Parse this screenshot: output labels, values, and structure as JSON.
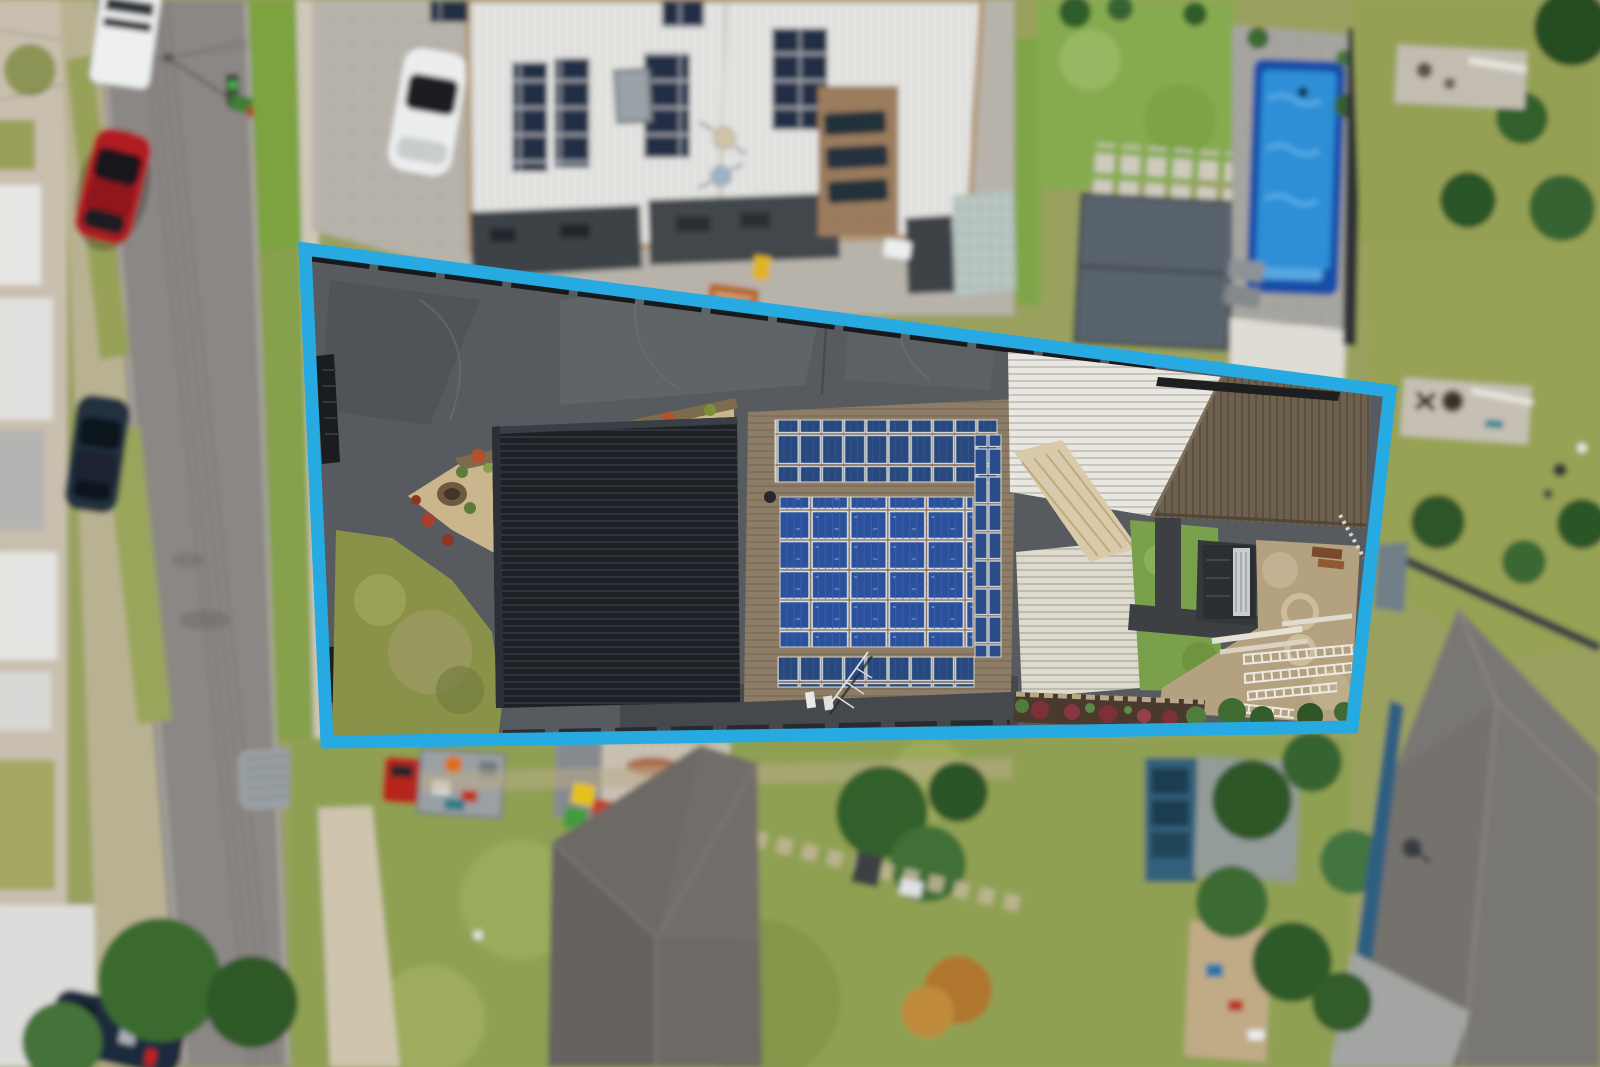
{
  "scene": {
    "type": "aerial-drone-photo",
    "description": "Top-down drone photograph of a long suburban block highlighted with a bright blue property boundary. Inside the boundary: dark stamped-concrete driveway, black metal garage roof, brown-tiled house roof densely covered with blue solar panels, cream corrugated pergola roofs, rear tiled garage, lawns, gravel garden and a dirt yard with ladders. Surroundings: street with parked cars on the left, large white-roofed modern house with solar panels and a blue swimming pool at top, neighbouring backyards, sheds and grey tiled roofs below.",
    "highlight": {
      "label": "property-boundary",
      "color": "#27aae1",
      "points": "305,249 1390,391 1352,727 327,742",
      "stroke_width": 13
    }
  },
  "colors": {
    "boundary": "#27aae1",
    "road": "#8b8784",
    "driveway_concrete": "#575b60",
    "black_roof": "#1d2125",
    "main_roof_tiles": "#8d7c66",
    "solar_panel_blue": "#2b519c",
    "white_metal_roof": "#e9e9e7",
    "pool_water": "#2f8ed6",
    "pool_shell": "#1350a8",
    "lawn_green": "#8fa052",
    "lawn_bright": "#86ab4f",
    "gravel": "#cbb58d",
    "dirt_yard": "#b3a17f",
    "rear_roof_brown": "#6d604d",
    "grey_hip_roof": "#7b7874"
  },
  "objects": {
    "inside_boundary": [
      {
        "name": "stamped-concrete-driveway"
      },
      {
        "name": "black-ribbed-garage-roof"
      },
      {
        "name": "solar-roof-house",
        "panel_groups": [
          "top-strip-2-rows",
          "center-array-5x5",
          "right-column",
          "bottom-strip"
        ]
      },
      {
        "name": "gravel-garden-triangle",
        "features": [
          "fire-pit",
          "red-hedge"
        ]
      },
      {
        "name": "front-lawn-patchy"
      },
      {
        "name": "cream-pergola-roofs",
        "count": 3
      },
      {
        "name": "rear-tiled-garage-roof"
      },
      {
        "name": "back-lawn-with-path"
      },
      {
        "name": "skylight-shed"
      },
      {
        "name": "dirt-yard",
        "features": [
          "aluminium-ladders",
          "white-planks",
          "figure-8-mark"
        ]
      },
      {
        "name": "mulch-garden-bed-red-shrubs"
      },
      {
        "name": "tv-antenna"
      }
    ],
    "surroundings": [
      {
        "name": "street-left",
        "parked": [
          "white-truck",
          "red-car",
          "navy-car",
          "grey-van",
          "dark-blue-car"
        ]
      },
      {
        "name": "power-lines"
      },
      {
        "name": "traffic-light-green"
      },
      {
        "name": "white-roof-modern-house",
        "features": [
          "solar-panels",
          "satellite-dishes",
          "roof-window"
        ]
      },
      {
        "name": "swimming-pool-blue"
      },
      {
        "name": "gable-roof-studio"
      },
      {
        "name": "paver-stepping-path"
      },
      {
        "name": "rusty-corrugated-shed"
      },
      {
        "name": "flatbed-truck-red-cab"
      },
      {
        "name": "wheelie-bins",
        "colors": [
          "yellow",
          "green",
          "red"
        ]
      },
      {
        "name": "grey-hip-roof-house-bottom"
      },
      {
        "name": "bottom-right-house-grey-roof",
        "features": [
          "satellite-dish",
          "patio-roof",
          "teal-walls"
        ]
      },
      {
        "name": "backyard-lawns"
      },
      {
        "name": "street-trees"
      }
    ]
  }
}
